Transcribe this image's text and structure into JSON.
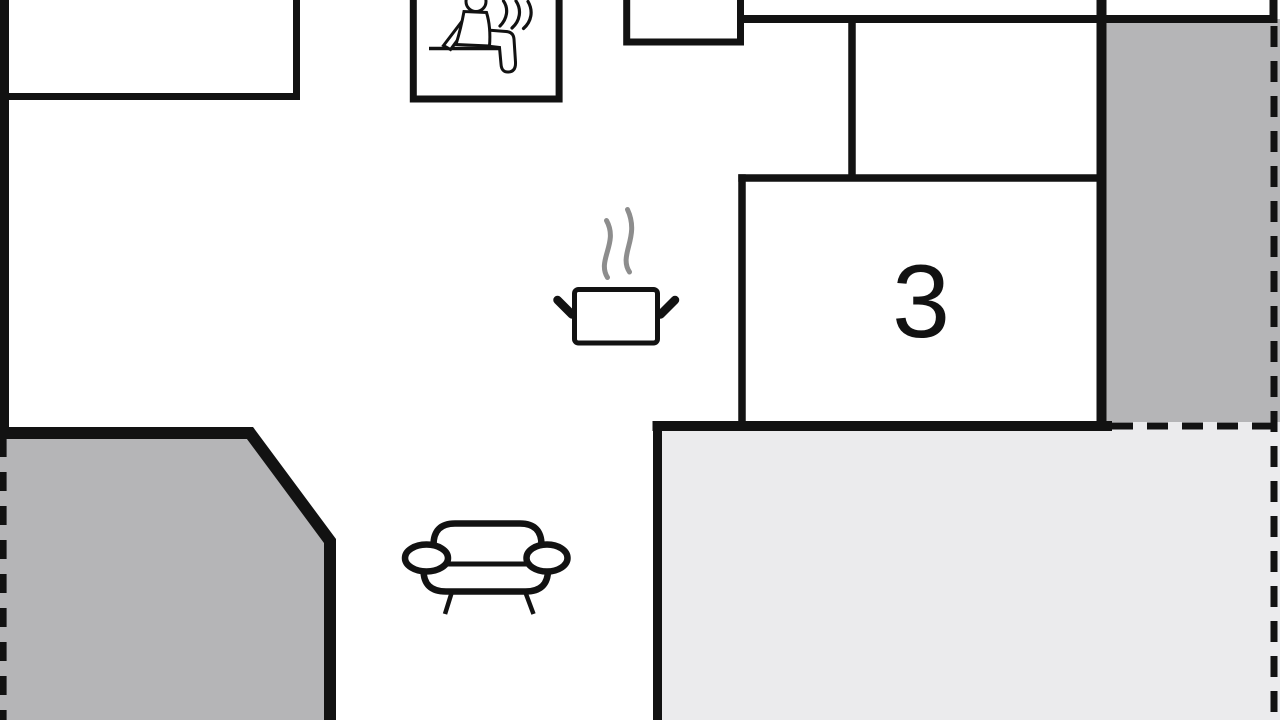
{
  "floorplan": {
    "room_label": "3",
    "colors": {
      "wall": "#121212",
      "terrace": "#b5b5b7",
      "veranda": "#ebebed",
      "steam": "#8d8d8d",
      "background": "#ffffff"
    },
    "icons": [
      {
        "name": "sauna-icon"
      },
      {
        "name": "cooking-pot-icon"
      },
      {
        "name": "sofa-icon"
      }
    ]
  }
}
